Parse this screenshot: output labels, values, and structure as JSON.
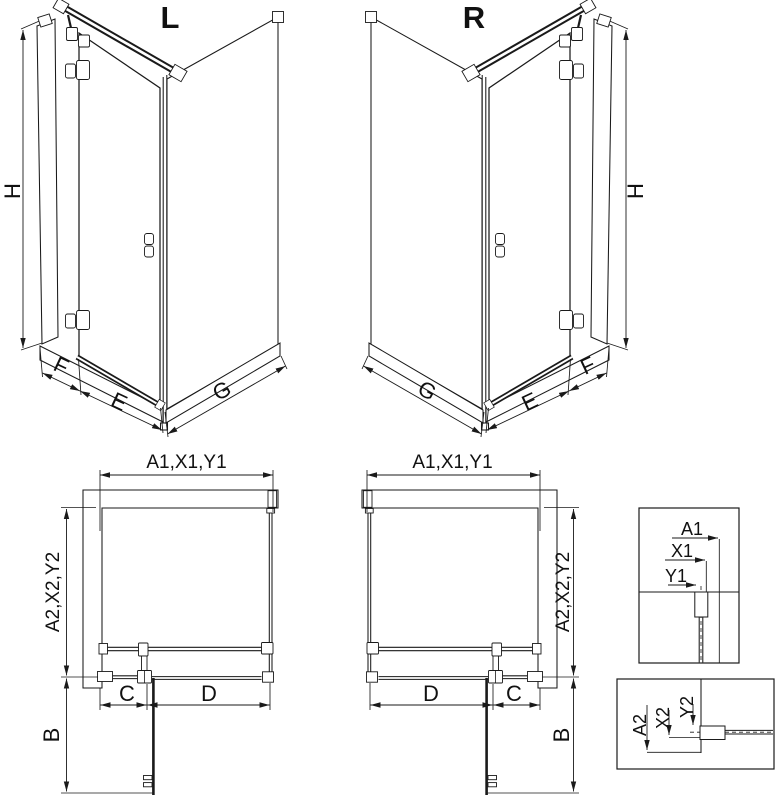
{
  "page": {
    "background": "#ffffff",
    "line_color": "#1a1a1a"
  },
  "iso_left": {
    "label": "L",
    "dim_height": "H",
    "dim_fixed": "F",
    "dim_door": "E",
    "dim_side": "G"
  },
  "iso_right": {
    "label": "R",
    "dim_height": "H",
    "dim_fixed": "F",
    "dim_door": "E",
    "dim_side": "G"
  },
  "plan_left": {
    "dim_width": "A1,X1,Y1",
    "dim_depth": "A2,X2,Y2",
    "dim_swing": "B",
    "dim_fixed": "C",
    "dim_door": "D"
  },
  "plan_right": {
    "dim_width": "A1,X1,Y1",
    "dim_depth": "A2,X2,Y2",
    "dim_swing": "B",
    "dim_fixed": "C",
    "dim_door": "D"
  },
  "detail_width": {
    "a1": "A1",
    "x1": "X1",
    "y1": "Y1"
  },
  "detail_depth": {
    "a2": "A2",
    "x2": "X2",
    "y2": "Y2"
  }
}
